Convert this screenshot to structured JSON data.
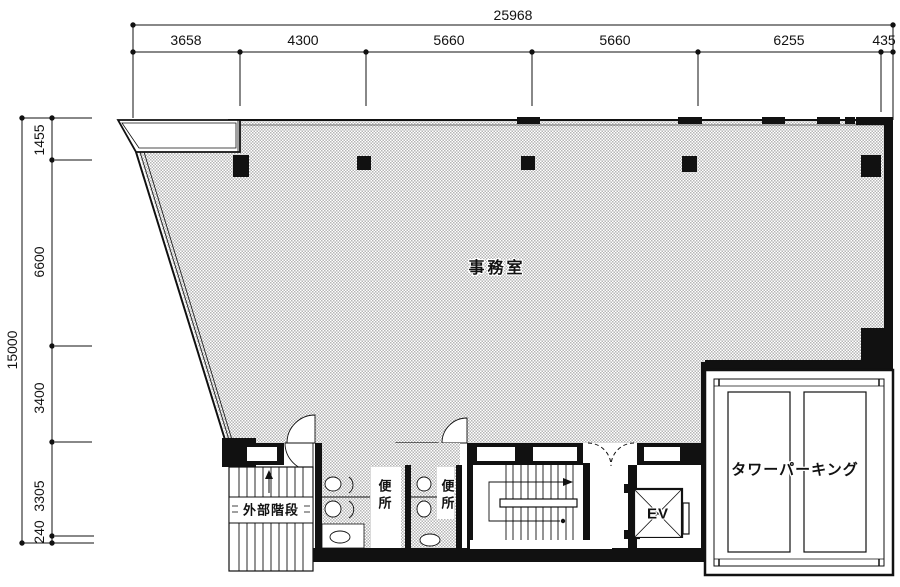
{
  "dimensions": {
    "top": {
      "total": "25968",
      "segments": [
        "3658",
        "4300",
        "5660",
        "5660",
        "6255",
        "435"
      ]
    },
    "left": {
      "total": "15000",
      "segments": [
        "1455",
        "6600",
        "3400",
        "3305",
        "240"
      ]
    }
  },
  "rooms": {
    "office": "事務室",
    "tower_parking": "タワーパーキング",
    "external_stair": "外部階段",
    "toilet_left": "便所",
    "toilet_right": "便所",
    "elevator": "EV"
  },
  "colors": {
    "line": "#111111",
    "hatch": "#b5b5b5",
    "background": "#ffffff"
  }
}
